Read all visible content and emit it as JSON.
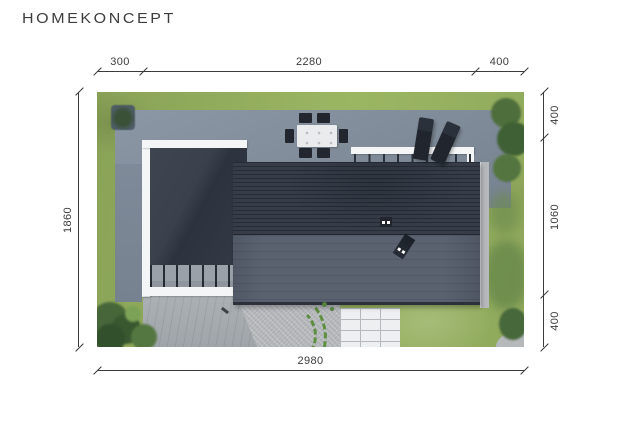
{
  "brand": {
    "logo": "HOMEKONCEPT"
  },
  "dims": {
    "top": [
      {
        "label": "300"
      },
      {
        "label": "2280"
      },
      {
        "label": "400"
      }
    ],
    "left": [
      {
        "label": "1860"
      }
    ],
    "right": [
      {
        "label": "400"
      },
      {
        "label": "1060"
      },
      {
        "label": "400"
      }
    ],
    "bottom": [
      {
        "label": "2980"
      }
    ]
  },
  "colors": {
    "page-bg": "#ffffff",
    "ink": "#3b3b3b",
    "logo-ink": "#3d3d3d",
    "lawn-a": "#89a257",
    "lawn-b": "#9bb663",
    "lawn-c": "#8fa95c",
    "shadow-green": "#6c8c4d",
    "paving-a": "#8b97a5",
    "paving-b": "#76828f",
    "paving-side": "#7e8a99",
    "carport-a": "#3e4551",
    "carport-b": "#2d333e",
    "roof-upper": "#363d49",
    "roof-lower": "#5a6270",
    "roof-edge": "#2c313a",
    "white-trim": "#f4f5f6",
    "slat-bg": "#9aa1a8",
    "gravel": "#b6b9bc",
    "driveway-a": "#abb0b4",
    "driveway-b": "#9fa5aa",
    "path-white": "#edeff1",
    "path-line": "#b4b9bd",
    "furniture": "#22272f",
    "table-top": "#e9ebed",
    "plant-green": "#5d8f3f",
    "chimney": "#21262e"
  },
  "scene": {
    "elements": [
      "lawn",
      "paved-terrace",
      "carport-roof",
      "slatted-canopy",
      "main-house-roof",
      "pergola",
      "dining-set",
      "sun-loungers",
      "chimneys",
      "driveway",
      "gravel-beds",
      "garden-path",
      "hedges",
      "trees",
      "tree-shadows"
    ]
  }
}
